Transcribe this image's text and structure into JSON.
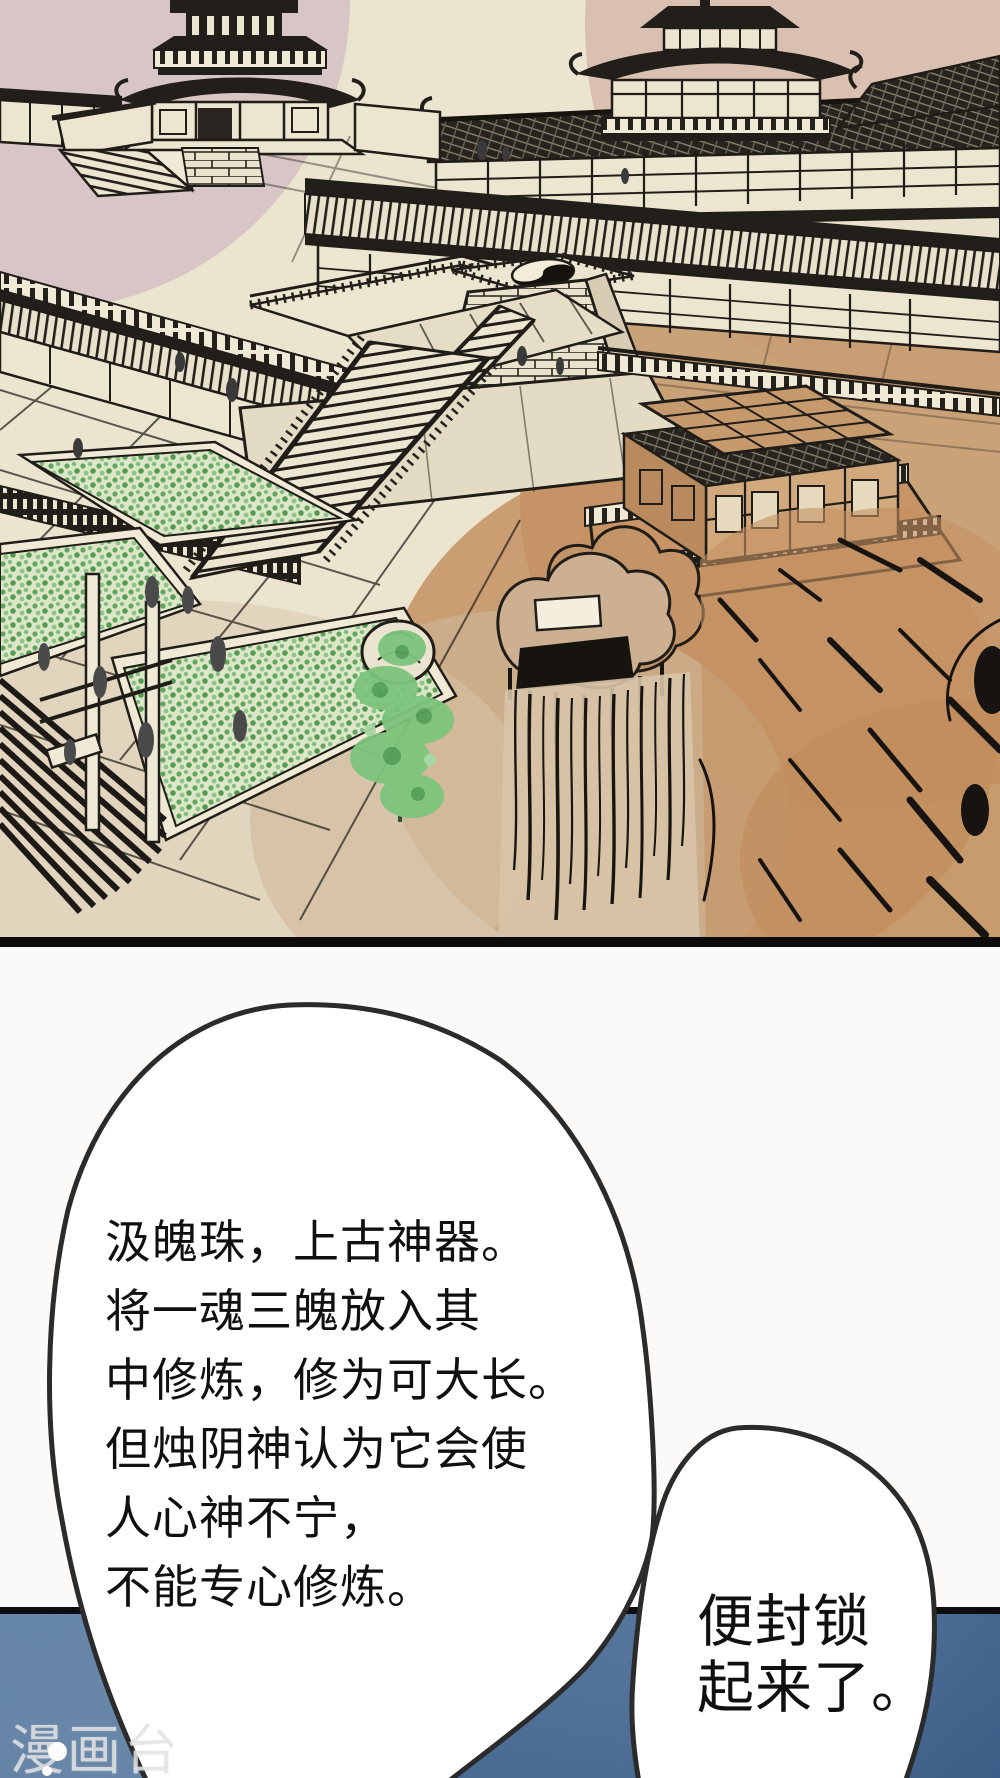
{
  "palette": {
    "page_bg": "#fbfaf8",
    "paper_cream": "#ebe4cf",
    "ink": "#201d19",
    "wash_pink_left": "#d2bbc1",
    "wash_pink_right": "#d5b6a7",
    "wash_tan": "#c79a6e",
    "wash_beige": "#d7c5ab",
    "hedge_green_dark": "#55994f",
    "hedge_green_light": "#8cc787",
    "tree_green": "#7cc47d",
    "panel_border_black": "#0d0d0f",
    "panel_blue_top": "#5b7da1",
    "panel_blue_bottom": "#3a5b85",
    "bubble_fill": "#ffffff",
    "bubble_stroke": "#2b2b2b",
    "watermark_color": "#e2e2e2"
  },
  "illustration": {
    "icons": [
      "pagoda-icon",
      "pavilion-icon",
      "yinyang-icon",
      "staircase-icon",
      "waterfall-icon",
      "pine-tree-icon"
    ]
  },
  "speech_bubbles": {
    "bubble1": {
      "lines": [
        "汲魄珠，上古神器。",
        "将一魂三魄放入其",
        "中修炼，修为可大长。",
        "但烛阴神认为它会使",
        "人心神不宁，",
        "不能专心修炼。"
      ]
    },
    "bubble2": {
      "lines": [
        "便封锁",
        "起来了。"
      ]
    }
  },
  "watermark": {
    "text": "漫画台"
  }
}
